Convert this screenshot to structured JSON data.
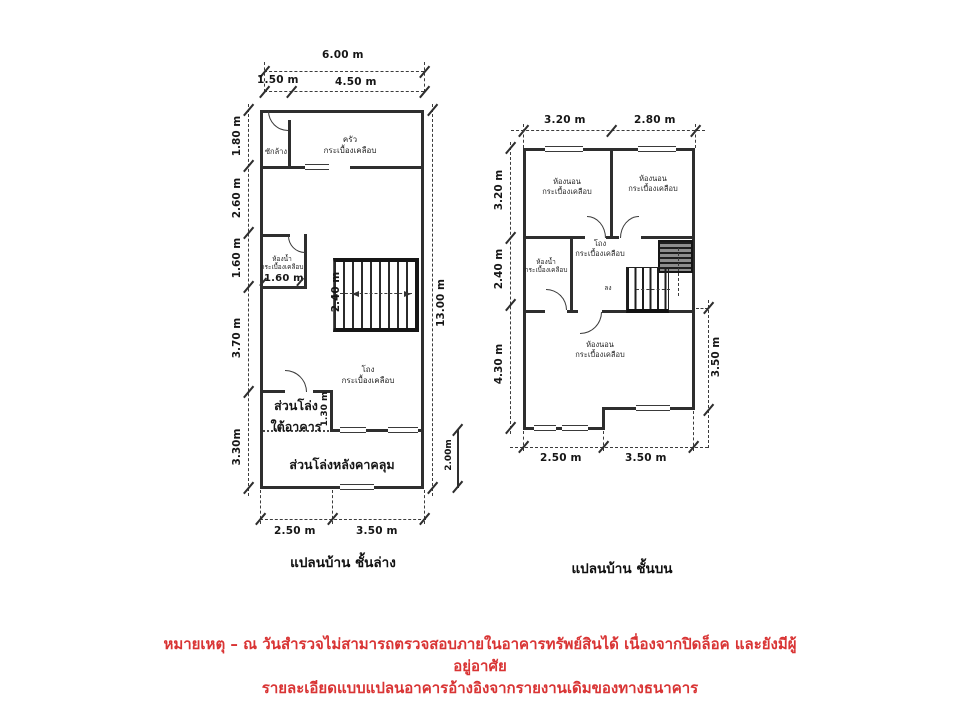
{
  "colors": {
    "ink": "#2e2e2e",
    "note_red": "#d93434",
    "paper": "#ffffff"
  },
  "ground_plan": {
    "title": "แปลนบ้าน ชั้นล่าง",
    "dims": {
      "top_total": "6.00 m",
      "top_seg1": "1.50 m",
      "top_seg2": "4.50 m",
      "left_1": "1.80 m",
      "left_2": "2.60 m",
      "left_3": "1.60 m",
      "left_4": "3.70 m",
      "left_5": "3.30m",
      "right_total": "13.00 m",
      "right_lower": "2.00m",
      "bottom_1": "2.50 m",
      "bottom_2": "3.50 m",
      "bath_width": "1.60 m",
      "stair_width": "2.40 m",
      "under_open_height": "1.30 m"
    },
    "rooms": {
      "laundry": "ซักล้าง",
      "kitchen_1": "ครัว",
      "kitchen_2": "กระเบื้องเคลือบ",
      "bath_1": "ห้องน้ำ",
      "bath_2": "กระเบื้องเคลือบ",
      "hall_1": "โถง",
      "hall_2": "กระเบื้องเคลือบ",
      "open_under_1": "ส่วนโล่ง",
      "open_under_2": "ใต้อาคาร",
      "open_roofed": "ส่วนโล่งหลังคาคลุม"
    }
  },
  "upper_plan": {
    "title": "แปลนบ้าน ชั้นบน",
    "dims": {
      "top_1": "3.20 m",
      "top_2": "2.80 m",
      "left_1": "3.20 m",
      "left_2": "2.40 m",
      "left_3": "4.30 m",
      "right_1": "3.50 m",
      "bottom_1": "2.50 m",
      "bottom_2": "3.50 m"
    },
    "rooms": {
      "bedroom1_1": "ห้องนอน",
      "bedroom1_2": "กระเบื้องเคลือบ",
      "bedroom2_1": "ห้องนอน",
      "bedroom2_2": "กระเบื้องเคลือบ",
      "bedroom3_1": "ห้องนอน",
      "bedroom3_2": "กระเบื้องเคลือบ",
      "bath_1": "ห้องน้ำ",
      "bath_2": "กระเบื้องเคลือบ",
      "hall_1": "โถง",
      "hall_2": "กระเบื้องเคลือบ",
      "stairs_direction": "ลง"
    }
  },
  "notes": {
    "line1": "หมายเหตุ – ณ วันสำรวจไม่สามารถตรวจสอบภายในอาคารทรัพย์สินได้ เนื่องจากปิดล็อค และยังมีผู้",
    "line2": "อยู่อาศัย",
    "line3": "รายละเอียดแบบแปลนอาคารอ้างอิงจากรายงานเดิมของทางธนาคาร"
  }
}
